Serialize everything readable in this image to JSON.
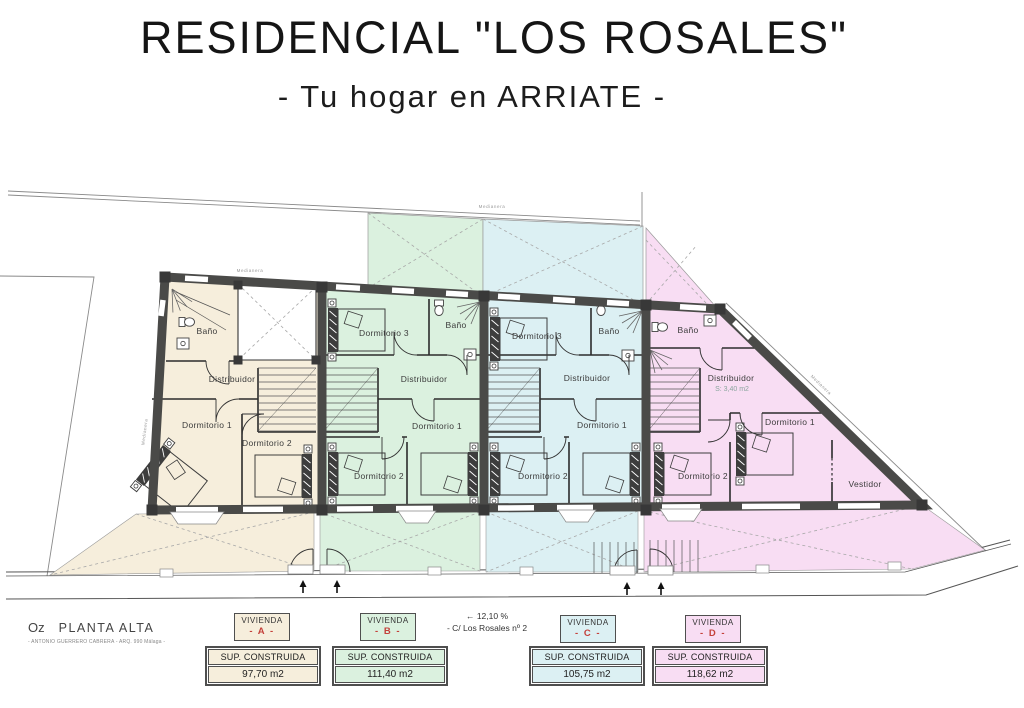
{
  "header": {
    "title": "RESIDENCIAL \"LOS ROSALES\"",
    "subtitle": "- Tu hogar en ARRIATE -"
  },
  "plan": {
    "medianera": "Medianera",
    "units": [
      {
        "name": "A",
        "rooms": {
          "bano": "Baño",
          "distribuidor": "Distribuidor",
          "dormitorio1": "Dormitorio 1",
          "dormitorio2": "Dormitorio 2"
        }
      },
      {
        "name": "B",
        "rooms": {
          "dormitorio3": "Dormitorio 3",
          "bano": "Baño",
          "distribuidor": "Distribuidor",
          "dormitorio1": "Dormitorio 1",
          "dormitorio2": "Dormitorio 2"
        }
      },
      {
        "name": "C",
        "rooms": {
          "dormitorio3": "Dormitorio 3",
          "bano": "Baño",
          "distribuidor": "Distribuidor",
          "dormitorio1": "Dormitorio 1",
          "dormitorio2": "Dormitorio 2"
        }
      },
      {
        "name": "D",
        "rooms": {
          "bano": "Baño",
          "distribuidor": "Distribuidor",
          "distribuidor_sup": "S: 3,40 m2",
          "dormitorio1": "Dormitorio 1",
          "dormitorio2": "Dormitorio 2",
          "vestidor": "Vestidor"
        }
      }
    ]
  },
  "footer": {
    "sheet_code": "Oz",
    "sheet_title": "PLANTA ALTA",
    "architect": "- ANTONIO GUERRERO CABRERA - ARQ. 990 Málaga -",
    "street_slope": "← 12,10 %",
    "street_name": "- C/ Los Rosales nº 2",
    "vivienda_label": "VIVIENDA",
    "sup_label": "SUP. CONSTRUIDA",
    "viviendas": [
      {
        "letter": "- A -",
        "area": "97,70 m2"
      },
      {
        "letter": "- B -",
        "area": "111,40 m2"
      },
      {
        "letter": "- C -",
        "area": "105,75 m2"
      },
      {
        "letter": "- D -",
        "area": "118,62 m2"
      }
    ]
  },
  "colors": {
    "unit_a": "#f6eedc",
    "unit_b": "#dbf1df",
    "unit_c": "#dcf0f3",
    "unit_d": "#f8ddf3",
    "wall": "#4a4a48",
    "accent_red": "#c4403a"
  }
}
